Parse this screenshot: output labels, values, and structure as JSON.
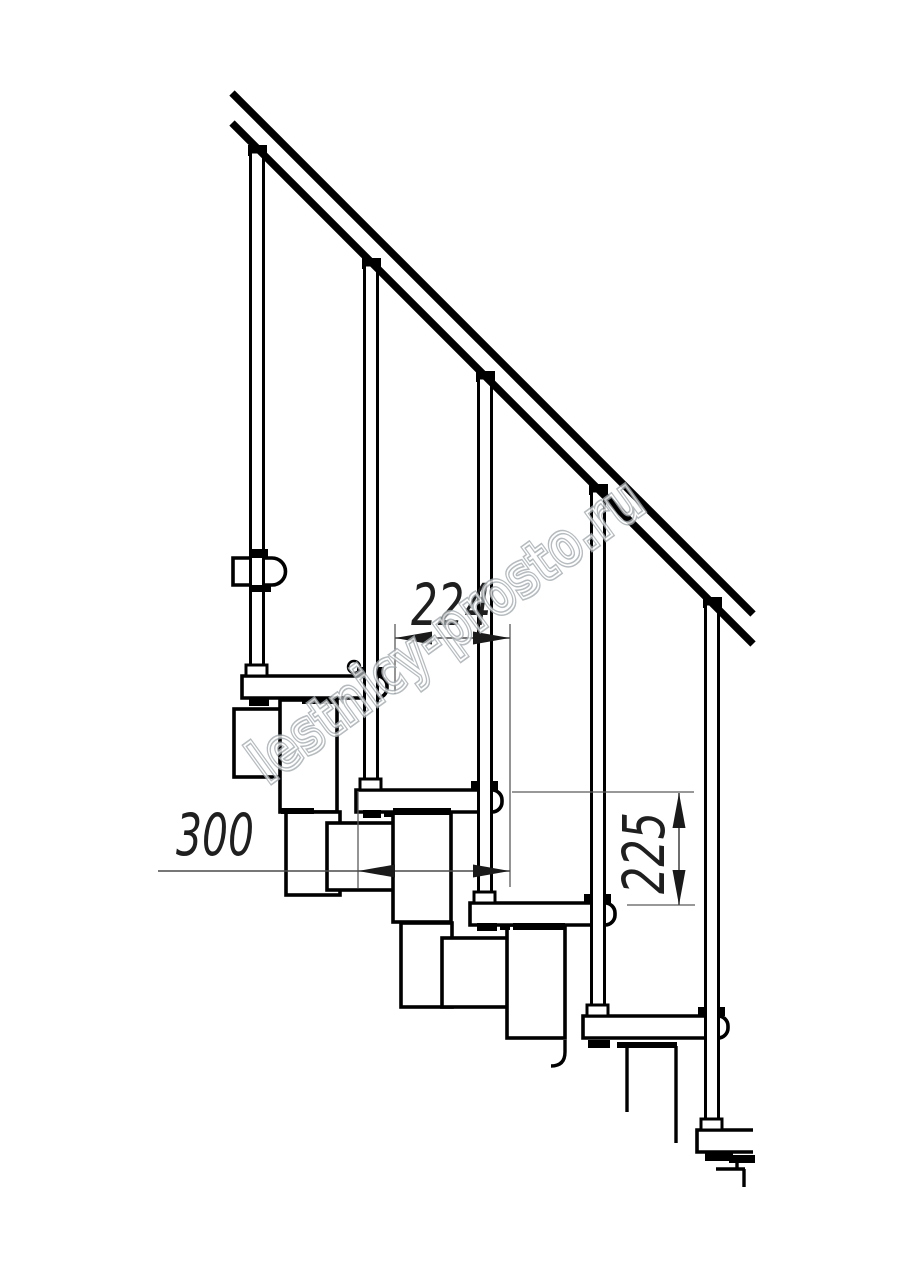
{
  "drawing": {
    "watermark_text": "lestnicy-prosto.ru",
    "dimensions": {
      "step_run": "224",
      "tread_depth": "300",
      "step_rise": "225"
    },
    "colors": {
      "background": "#ffffff",
      "linework": "#000000",
      "dimension": "#2f2f2f",
      "watermark_outline": "#a3abaf"
    }
  }
}
